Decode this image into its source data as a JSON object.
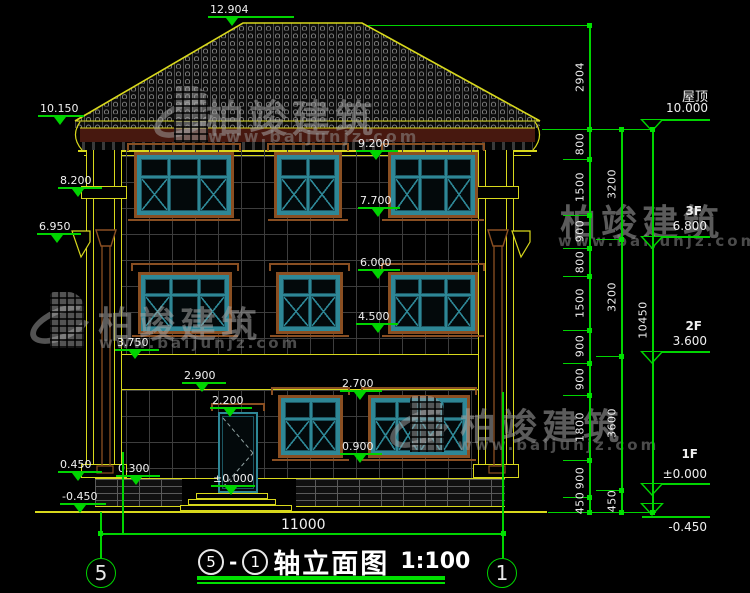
{
  "watermark": {
    "name": "柏竣建筑",
    "url": "www.baijunjz.com"
  },
  "annotations": [
    {
      "value": "12.904"
    },
    {
      "value": "10.150"
    },
    {
      "value": "9.200"
    },
    {
      "value": "8.200"
    },
    {
      "value": "7.700"
    },
    {
      "value": "6.950"
    },
    {
      "value": "6.000"
    },
    {
      "value": "4.500"
    },
    {
      "value": "3.750"
    },
    {
      "value": "2.900"
    },
    {
      "value": "2.700"
    },
    {
      "value": "2.200"
    },
    {
      "value": "0.900"
    },
    {
      "value": "0.450"
    },
    {
      "value": "0.300"
    },
    {
      "value": "±0.000"
    },
    {
      "value": "-0.450"
    }
  ],
  "floors": [
    {
      "label": "屋顶",
      "value": "10.000"
    },
    {
      "label": "3F",
      "value": "6.800"
    },
    {
      "label": "2F",
      "value": "3.600"
    },
    {
      "label": "1F",
      "value": "±0.000"
    },
    {
      "label": "",
      "value": "-0.450"
    }
  ],
  "dims": {
    "col1": [
      "2904",
      "800",
      "1500",
      "900",
      "800",
      "1500",
      "900",
      "900",
      "1800",
      "900",
      "450"
    ],
    "col2": [
      "3200",
      "3200",
      "3600",
      "450"
    ],
    "col3": [
      "10450"
    ],
    "bottom": "11000"
  },
  "axes": {
    "left": "5",
    "right": "1"
  },
  "title": {
    "bubble_left": "5",
    "separator": "-",
    "bubble_right": "1",
    "name": "轴立面图",
    "scale": "1:100"
  },
  "colors": {
    "dimension_green": "#00d400",
    "architecture_yellow": "#d8d81c",
    "frame_brown": "#8a4f22",
    "window_teal": "#2e8796",
    "fascia_maroon": "#47180f",
    "background": "#000000"
  }
}
